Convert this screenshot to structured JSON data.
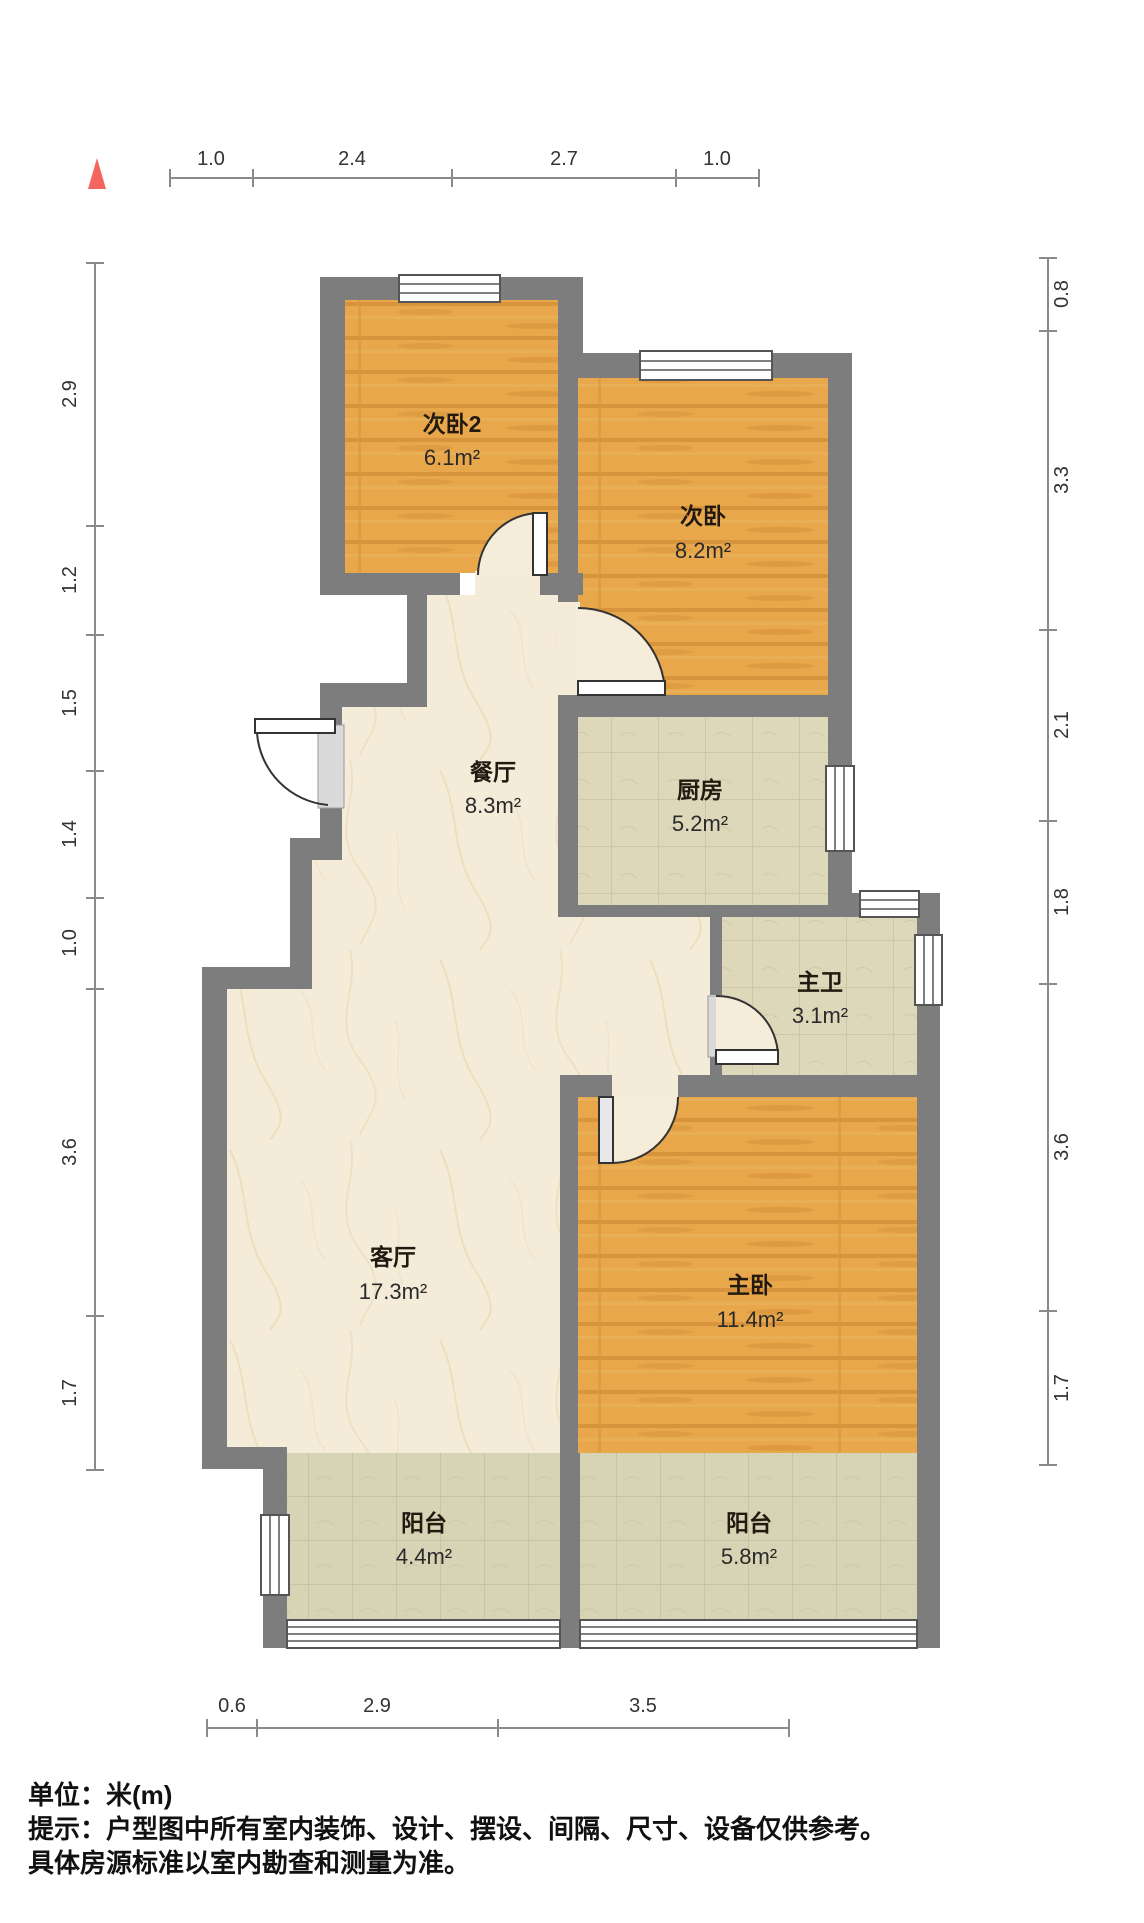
{
  "plan": {
    "type": "apartment-floorplan",
    "unit_note": "单位：米(m)",
    "tip_line1": "提示：户型图中所有室内装饰、设计、摆设、间隔、尺寸、设备仅供参考。",
    "tip_line2": "具体房源标准以室内勘查和测量为准。"
  },
  "rooms": [
    {
      "id": "bedroom2",
      "name": "次卧2",
      "area": "6.1m²",
      "floor": "wood"
    },
    {
      "id": "bedroom",
      "name": "次卧",
      "area": "8.2m²",
      "floor": "wood"
    },
    {
      "id": "dining",
      "name": "餐厅",
      "area": "8.3m²",
      "floor": "marble"
    },
    {
      "id": "kitchen",
      "name": "厨房",
      "area": "5.2m²",
      "floor": "tile"
    },
    {
      "id": "master-bath",
      "name": "主卫",
      "area": "3.1m²",
      "floor": "tile"
    },
    {
      "id": "living",
      "name": "客厅",
      "area": "17.3m²",
      "floor": "marble"
    },
    {
      "id": "master-bedroom",
      "name": "主卧",
      "area": "11.4m²",
      "floor": "wood"
    },
    {
      "id": "balcony-left",
      "name": "阳台",
      "area": "4.4m²",
      "floor": "tile"
    },
    {
      "id": "balcony-right",
      "name": "阳台",
      "area": "5.8m²",
      "floor": "tile"
    }
  ],
  "dimensions": {
    "top": [
      "1.0",
      "2.4",
      "2.7",
      "1.0"
    ],
    "left": [
      "2.9",
      "1.2",
      "1.5",
      "1.4",
      "1.0",
      "3.6",
      "1.7"
    ],
    "right": [
      "0.8",
      "3.3",
      "2.1",
      "1.8",
      "3.6",
      "1.7"
    ],
    "bottom": [
      "0.6",
      "2.9",
      "3.5"
    ]
  },
  "colors": {
    "wall": "#7d7d7d",
    "wood_floor": "#e8a74b",
    "marble_floor": "#f4ecd9",
    "tile_floor": "#ded8bb",
    "balcony_tile": "#d7d3b5",
    "north_arrow": "#f4655f"
  }
}
